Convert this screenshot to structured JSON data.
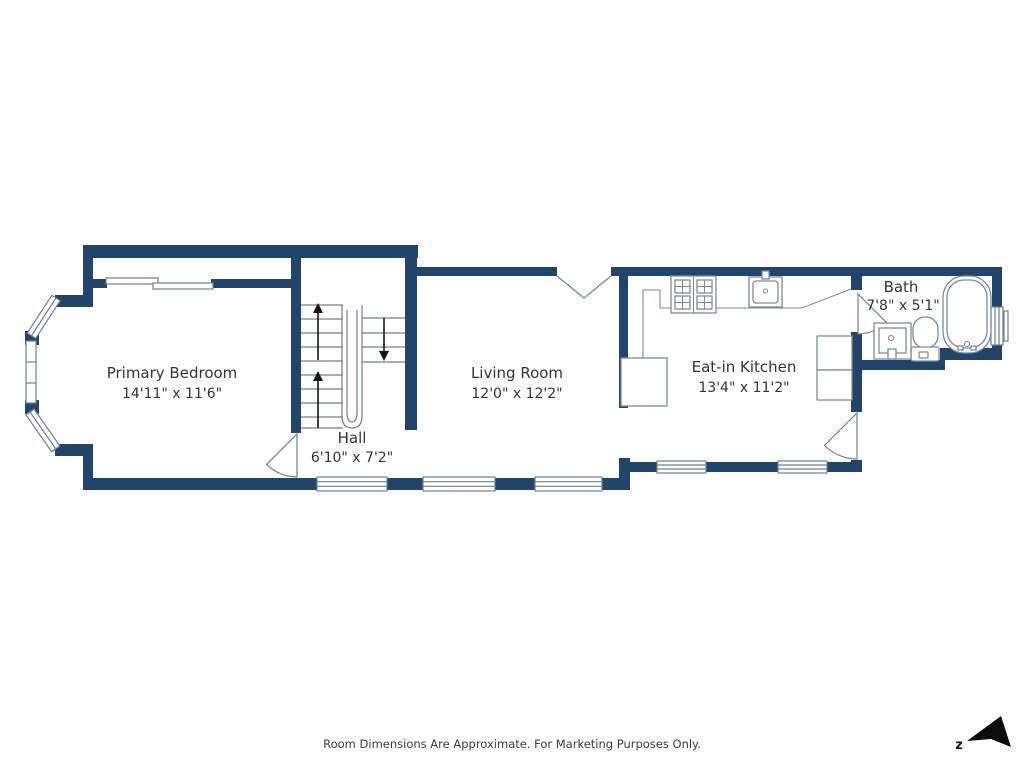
{
  "plan": {
    "rooms": {
      "primary_bedroom": {
        "name": "Primary Bedroom",
        "dimensions": "14'11\" x 11'6\""
      },
      "hall": {
        "name": "Hall",
        "dimensions": "6'10\" x 7'2\""
      },
      "living_room": {
        "name": "Living Room",
        "dimensions": "12'0\" x 12'2\""
      },
      "eat_in_kitchen": {
        "name": "Eat-in Kitchen",
        "dimensions": "13'4\" x 11'2\""
      },
      "bath": {
        "name": "Bath",
        "dimensions": "7'8\" x 5'1\""
      }
    },
    "fixtures": [
      "stairs-icon",
      "stove-icon",
      "kitchen-sink-icon",
      "bathtub-icon",
      "toilet-icon",
      "bath-sink-icon",
      "bay-window-icon",
      "door-swing-icon",
      "double-door-icon",
      "sliding-door-icon"
    ],
    "colors": {
      "wall": "#21456a",
      "line": "#72808f",
      "fixture": "#7e8a97",
      "text": "#32343c",
      "background": "#ffffff",
      "compass": "#0b0b0b"
    }
  },
  "footer": {
    "disclaimer": "Room Dimensions Are Approximate. For Marketing Purposes Only."
  },
  "compass": {
    "label": "z"
  }
}
